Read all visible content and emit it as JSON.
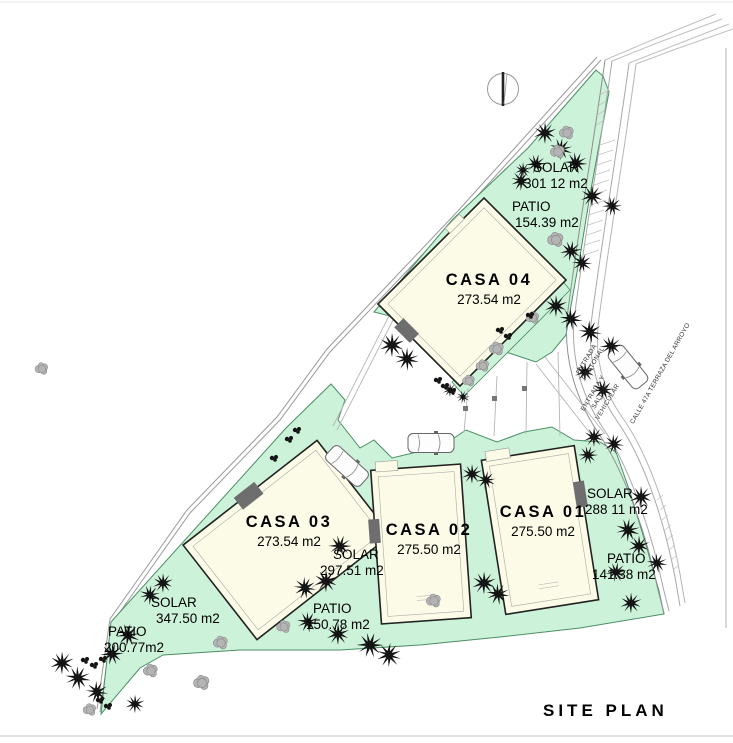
{
  "title": "SITE PLAN",
  "houses": [
    {
      "id": "casa-01",
      "name": "CASA 01",
      "area": "275.50 m2"
    },
    {
      "id": "casa-02",
      "name": "CASA 02",
      "area": "275.50 m2"
    },
    {
      "id": "casa-03",
      "name": "CASA 03",
      "area": "273.54 m2"
    },
    {
      "id": "casa-04",
      "name": "CASA 04",
      "area": "273.54 m2"
    }
  ],
  "zones": [
    {
      "id": "solar-north",
      "label": "SOLAR",
      "value": "301 12 m2"
    },
    {
      "id": "patio-north",
      "label": "PATIO",
      "value": "154.39 m2"
    },
    {
      "id": "solar-casa01",
      "label": "SOLAR",
      "value": "288 11 m2"
    },
    {
      "id": "patio-casa01",
      "label": "PATIO",
      "value": "141.38 m2"
    },
    {
      "id": "solar-casa02",
      "label": "SOLAR",
      "value": "297.51 m2"
    },
    {
      "id": "patio-casa02",
      "label": "PATIO",
      "value": "150.78 m2"
    },
    {
      "id": "solar-casa03",
      "label": "SOLAR",
      "value": "347.50 m2"
    },
    {
      "id": "patio-casa03",
      "label": "PATIO",
      "value": "200.77m2"
    }
  ],
  "streets": {
    "pedestrian_entrance": "ENTRADA PEATONAL",
    "vehicular_entrance": "ENTRADA Y SALIDA VEHICULAR",
    "street_name": "CALLE 47A TERRAZA DEL ARROYO"
  },
  "icons": {
    "north_arrow": "north-arrow-icon",
    "palm": "palm-tree-icon",
    "tree": "round-tree-icon",
    "bush": "bush-icon",
    "car": "car-icon"
  },
  "colors": {
    "green_fill": "#cdf2da",
    "green_stroke": "#4a8f63",
    "house_fill": "#fcfbe7",
    "house_stroke": "#222222",
    "garage_fill": "#6e6e6e",
    "line": "#a8a8a8",
    "tree_black": "#141414",
    "tree_gray": "#b4b4b4"
  },
  "plan": {
    "palms": [
      [
        545,
        133,
        1,
        0
      ],
      [
        561,
        149,
        1,
        40
      ],
      [
        536,
        164,
        0.9,
        15
      ],
      [
        521,
        181,
        0.9,
        70
      ],
      [
        523,
        170,
        0.7,
        0
      ],
      [
        576,
        163,
        1,
        25
      ],
      [
        592,
        196,
        1,
        0
      ],
      [
        612,
        206,
        0.9,
        50
      ],
      [
        571,
        251,
        0.95,
        10
      ],
      [
        582,
        263,
        0.9,
        55
      ],
      [
        556,
        306,
        1,
        0
      ],
      [
        571,
        319,
        1,
        30
      ],
      [
        590,
        332,
        1.05,
        60
      ],
      [
        611,
        346,
        0.95,
        15
      ],
      [
        585,
        372,
        0.9,
        0
      ],
      [
        603,
        390,
        0.95,
        45
      ],
      [
        392,
        345,
        1.1,
        0
      ],
      [
        407,
        359,
        1.05,
        35
      ],
      [
        450,
        390,
        0.65,
        0
      ],
      [
        463,
        397,
        0.6,
        50
      ],
      [
        340,
        546,
        1,
        20
      ],
      [
        326,
        581,
        1.05,
        0
      ],
      [
        305,
        588,
        1,
        60
      ],
      [
        308,
        622,
        0.95,
        30
      ],
      [
        338,
        634,
        1,
        0
      ],
      [
        370,
        645,
        1.15,
        20
      ],
      [
        389,
        655,
        1.1,
        70
      ],
      [
        472,
        474,
        0.9,
        0
      ],
      [
        486,
        480,
        0.85,
        45
      ],
      [
        484,
        583,
        1.05,
        0
      ],
      [
        498,
        594,
        1,
        30
      ],
      [
        594,
        437,
        0.9,
        0
      ],
      [
        614,
        444,
        0.9,
        60
      ],
      [
        588,
        455,
        0.85,
        20
      ],
      [
        641,
        497,
        1,
        0
      ],
      [
        628,
        530,
        1.05,
        40
      ],
      [
        639,
        546,
        0.95,
        0
      ],
      [
        657,
        563,
        0.9,
        30
      ],
      [
        616,
        572,
        0.9,
        10
      ],
      [
        631,
        603,
        0.95,
        0
      ],
      [
        62,
        663,
        1.05,
        0
      ],
      [
        78,
        678,
        1.1,
        30
      ],
      [
        97,
        692,
        1,
        60
      ],
      [
        112,
        654,
        1,
        15
      ],
      [
        128,
        635,
        1.05,
        45
      ],
      [
        135,
        704,
        0.85,
        0
      ],
      [
        163,
        583,
        0.9,
        0
      ],
      [
        150,
        595,
        0.9,
        40
      ]
    ],
    "gray_trees": [
      [
        567,
        133,
        1
      ],
      [
        558,
        152,
        1
      ],
      [
        556,
        240,
        1.1
      ],
      [
        533,
        318,
        0.9
      ],
      [
        497,
        349,
        1
      ],
      [
        483,
        366,
        0.9
      ],
      [
        469,
        381,
        0.85
      ],
      [
        42,
        369,
        0.9
      ],
      [
        202,
        683,
        1.1
      ],
      [
        221,
        643,
        1
      ],
      [
        90,
        710,
        0.9
      ],
      [
        434,
        601,
        1
      ],
      [
        284,
        627,
        0.95
      ],
      [
        151,
        671,
        1
      ]
    ],
    "bushes": [
      [
        297,
        430
      ],
      [
        289,
        439
      ],
      [
        274,
        458
      ],
      [
        85,
        660
      ],
      [
        94,
        665
      ],
      [
        103,
        659
      ],
      [
        100,
        700
      ],
      [
        108,
        706
      ],
      [
        445,
        386
      ],
      [
        452,
        391
      ],
      [
        438,
        380
      ],
      [
        500,
        330
      ],
      [
        508,
        336
      ],
      [
        530,
        315
      ]
    ],
    "cars": [
      [
        431,
        443,
        0
      ],
      [
        347,
        466,
        42
      ],
      [
        628,
        367,
        51
      ]
    ]
  }
}
